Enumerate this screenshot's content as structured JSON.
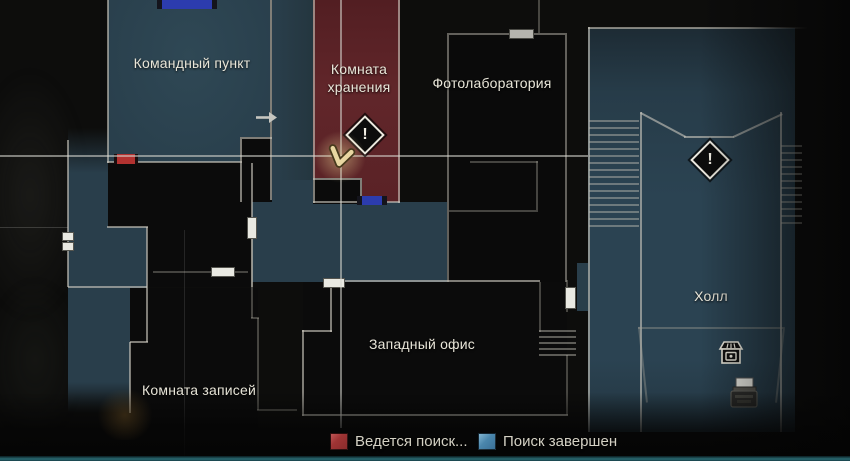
{
  "screen": {
    "name": "game-map-screen"
  },
  "map": {
    "rooms": [
      {
        "id": "command-post",
        "label": "Командный пункт",
        "status": "search-complete"
      },
      {
        "id": "storage-room",
        "label": "Комната хранения",
        "status": "search-in-progress"
      },
      {
        "id": "photo-lab",
        "label": "Фотолаборатория",
        "status": "unexplored"
      },
      {
        "id": "hall",
        "label": "Холл",
        "status": "search-complete"
      },
      {
        "id": "west-office",
        "label": "Западный офис",
        "status": "unexplored"
      },
      {
        "id": "records-room",
        "label": "Комната записей",
        "status": "unexplored"
      }
    ],
    "objective_glyph": "!",
    "icons": [
      {
        "name": "player-position-icon",
        "shape": "chevron-pointer"
      },
      {
        "name": "objective-icon",
        "shape": "exclamation-diamond",
        "count": 2
      },
      {
        "name": "item-box-icon",
        "shape": "storage-box"
      },
      {
        "name": "save-point-typewriter-icon",
        "shape": "typewriter"
      },
      {
        "name": "map-transition-arrow-icon",
        "shape": "arrow-right"
      }
    ],
    "colors": {
      "room_search_complete": "#2b4250",
      "room_search_in_progress": "#5c2226",
      "room_unexplored": "#0b0b0b",
      "wall": "#cecbc0",
      "door_blue": "#2c3cae",
      "door_red": "#b23230",
      "door_white": "#e9e9e2"
    }
  },
  "legend": {
    "items": [
      {
        "label": "Ведется поиск...",
        "color": "#9e3434",
        "swatch": "red-square"
      },
      {
        "label": "Поиск завершен",
        "color": "#4a86ac",
        "swatch": "blue-square"
      }
    ]
  }
}
